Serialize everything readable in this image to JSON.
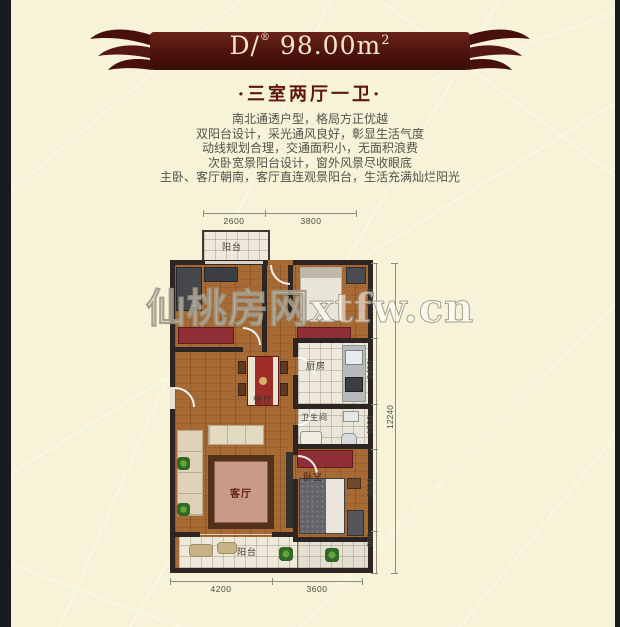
{
  "header": {
    "unit": "D/",
    "mark": "®",
    "area": "98.00m",
    "area_sup": "2",
    "subtitle": "·三室两厅一卫·"
  },
  "description": {
    "lines": [
      "南北通透户型，格局方正优越",
      "双阳台设计，采光通风良好，彰显生活气度",
      "动线规划合理，交通面积小，无面积浪费",
      "次卧宽景阳台设计，窗外风景尽收眼底",
      "主卧、客厅朝南，客厅直连观景阳台，生活充满灿烂阳光"
    ]
  },
  "floorplan": {
    "labels": {
      "balcony_top": "阳台",
      "kitchen": "厨房",
      "bathroom": "卫生间",
      "dining": "餐厅",
      "living": "客厅",
      "bedroom": "卧室",
      "balcony_bottom": "阳台"
    },
    "dimensions": {
      "top": [
        "2600",
        "3800"
      ],
      "bottom": [
        "4200",
        "3600"
      ],
      "right": [
        "3540",
        "2400",
        "1800",
        "3600",
        "900"
      ],
      "right_total": "12240"
    }
  },
  "watermark": "仙桃房网xtfw.cn",
  "colors": {
    "background": "#f7f3d9",
    "banner_maroon": "#4d130c",
    "subtitle_red": "#5d150e",
    "wall": "#2c2521",
    "wood_floor": "#a86a34",
    "red_furniture": "#8e2f35"
  }
}
